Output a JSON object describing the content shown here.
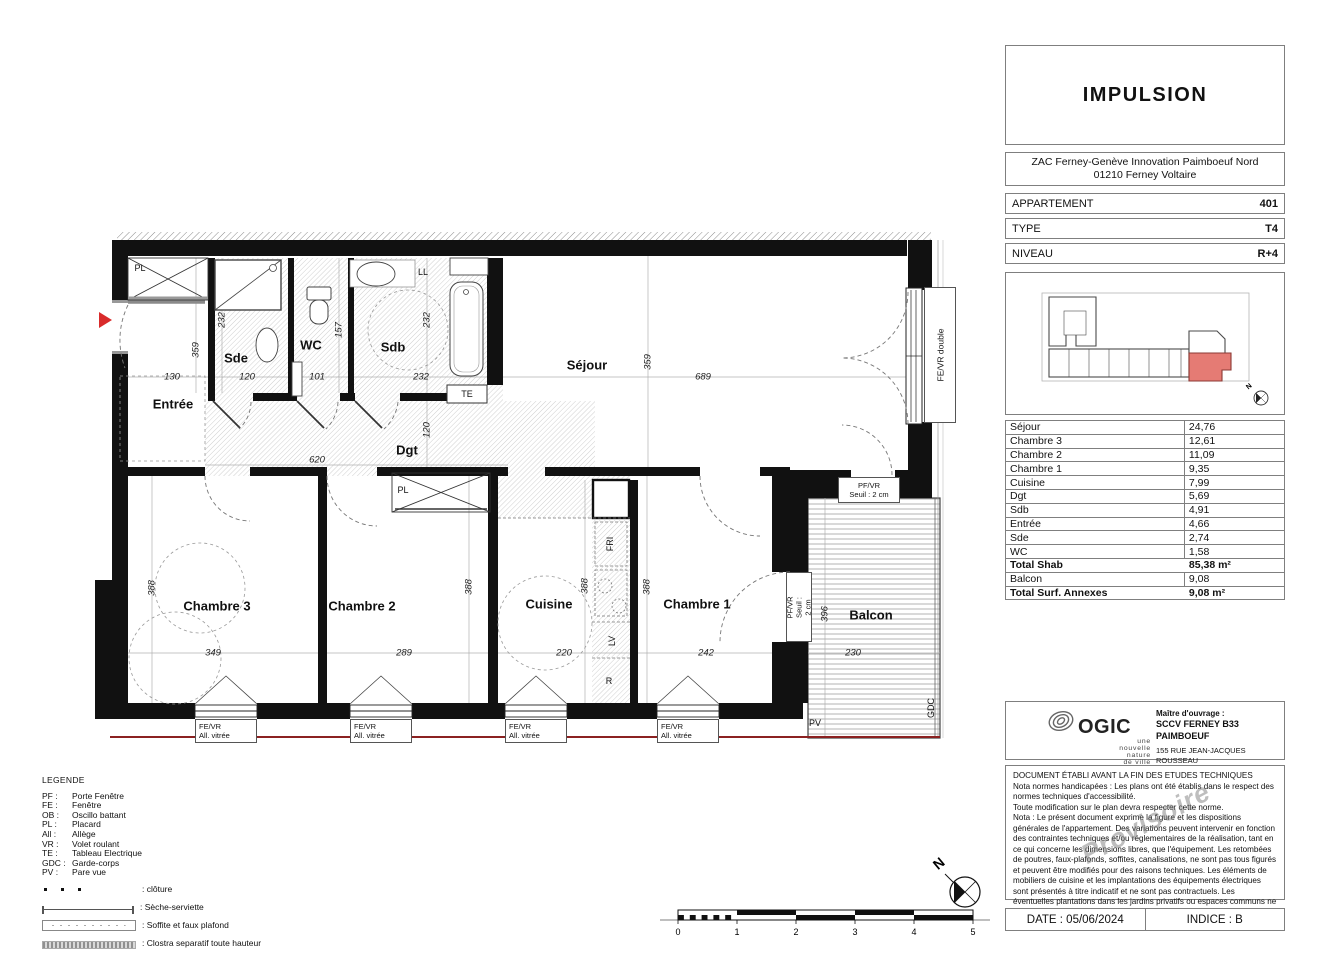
{
  "panel": {
    "project_title": "IMPULSION",
    "address_line1": "ZAC Ferney-Genève Innovation Paimboeuf Nord",
    "address_line2": "01210 Ferney Voltaire",
    "info_rows": [
      {
        "label": "APPARTEMENT",
        "value": "401"
      },
      {
        "label": "TYPE",
        "value": "T4"
      },
      {
        "label": "NIVEAU",
        "value": "R+4"
      }
    ],
    "areas": [
      {
        "label": "Séjour",
        "value": "24,76",
        "bold": false
      },
      {
        "label": "Chambre 3",
        "value": "12,61",
        "bold": false
      },
      {
        "label": "Chambre 2",
        "value": "11,09",
        "bold": false
      },
      {
        "label": "Chambre 1",
        "value": "9,35",
        "bold": false
      },
      {
        "label": "Cuisine",
        "value": "7,99",
        "bold": false
      },
      {
        "label": "Dgt",
        "value": "5,69",
        "bold": false
      },
      {
        "label": "Sdb",
        "value": "4,91",
        "bold": false
      },
      {
        "label": "Entrée",
        "value": "4,66",
        "bold": false
      },
      {
        "label": "Sde",
        "value": "2,74",
        "bold": false
      },
      {
        "label": "WC",
        "value": "1,58",
        "bold": false
      },
      {
        "label": "Total Shab",
        "value": "85,38 m²",
        "bold": true
      },
      {
        "label": "Balcon",
        "value": "9,08",
        "bold": false
      },
      {
        "label": "Total Surf. Annexes",
        "value": "9,08 m²",
        "bold": true
      }
    ],
    "developer": {
      "logo_text": "OGIC",
      "logo_tagline_lines": [
        "une",
        "nouvelle",
        "nature",
        "de ville"
      ],
      "owner_label": "Maître d'ouvrage :",
      "owner_name": "SCCV FERNEY B33 PAIMBOEUF",
      "owner_address1": "155 RUE JEAN-JACQUES ROUSSEAU",
      "owner_address2": "92 130 Issy-Les-Moulineaux"
    },
    "notes": {
      "title": "DOCUMENT ÉTABLI AVANT LA FIN DES ETUDES TECHNIQUES",
      "p1": "Nota normes handicapées : Les plans ont été établis dans le respect des normes techniques d'accessibilité.",
      "p2": "Toute modification sur le plan devra respecter cette norme.",
      "p3": "Nota : Le présent document exprime la figure et les dispositions générales de l'appartement. Des variations peuvent intervenir en fonction des contraintes techniques et/ou réglementaires de la réalisation, tant en ce qui concerne les dimensions libres, que l'équipement. Les retombées de poutres, faux-plafonds, soffites, canalisations, ne sont pas tous figurés et peuvent être modifiés pour des raisons techniques. Les éléments de mobiliers de cuisine et les implantations des équipements électriques sont présentés à titre indicatif et ne sont pas contractuels. Les éventuelles plantations dans les jardins privatifs ou espaces communs ne sont pas contractuelles. Les placards et/ou rangements intérieurs sont compris dans la surface de la pièce attenante.",
      "watermark": "Provisoire"
    },
    "footer": {
      "date": "DATE : 05/06/2024",
      "indice": "INDICE : B"
    }
  },
  "legend": {
    "title": "LEGENDE",
    "abbrev": [
      {
        "abbr": "PF :",
        "label": "Porte Fenêtre"
      },
      {
        "abbr": "FE :",
        "label": "Fenêtre"
      },
      {
        "abbr": "OB :",
        "label": "Oscillo battant"
      },
      {
        "abbr": "PL :",
        "label": "Placard"
      },
      {
        "abbr": "All :",
        "label": "Allège"
      },
      {
        "abbr": "VR :",
        "label": "Volet roulant"
      },
      {
        "abbr": "TE :",
        "label": "Tableau Electrique"
      },
      {
        "abbr": "GDC :",
        "label": "Garde-corps"
      },
      {
        "abbr": "PV :",
        "label": "Pare vue"
      }
    ],
    "symbols": [
      {
        "type": "cloture",
        "label": ": clôture"
      },
      {
        "type": "seche",
        "label": ": Sèche-serviette"
      },
      {
        "type": "soffite",
        "label": ": Soffite et faux plafond"
      },
      {
        "type": "clostra",
        "label": ": Clostra separatif toute hauteur"
      }
    ]
  },
  "plan": {
    "north": "N",
    "labels": [
      {
        "t": "Entrée",
        "x": 78,
        "y": 176,
        "k": "room"
      },
      {
        "t": "Sde",
        "x": 141,
        "y": 130,
        "k": "room"
      },
      {
        "t": "WC",
        "x": 216,
        "y": 117,
        "k": "room"
      },
      {
        "t": "Sdb",
        "x": 298,
        "y": 119,
        "k": "room"
      },
      {
        "t": "Séjour",
        "x": 492,
        "y": 137,
        "k": "room"
      },
      {
        "t": "Dgt",
        "x": 312,
        "y": 222,
        "k": "room"
      },
      {
        "t": "Chambre 3",
        "x": 122,
        "y": 378,
        "k": "room"
      },
      {
        "t": "Chambre 2",
        "x": 267,
        "y": 378,
        "k": "room"
      },
      {
        "t": "Cuisine",
        "x": 454,
        "y": 376,
        "k": "room"
      },
      {
        "t": "Chambre 1",
        "x": 602,
        "y": 376,
        "k": "room"
      },
      {
        "t": "Balcon",
        "x": 776,
        "y": 387,
        "k": "room"
      },
      {
        "t": "130",
        "x": 77,
        "y": 149,
        "k": "dim"
      },
      {
        "t": "120",
        "x": 152,
        "y": 149,
        "k": "dim"
      },
      {
        "t": "101",
        "x": 222,
        "y": 149,
        "k": "dim"
      },
      {
        "t": "232",
        "x": 326,
        "y": 149,
        "k": "dim"
      },
      {
        "t": "689",
        "x": 608,
        "y": 149,
        "k": "dim"
      },
      {
        "t": "620",
        "x": 222,
        "y": 232,
        "k": "dim"
      },
      {
        "t": "349",
        "x": 118,
        "y": 425,
        "k": "dim"
      },
      {
        "t": "289",
        "x": 309,
        "y": 425,
        "k": "dim"
      },
      {
        "t": "220",
        "x": 469,
        "y": 425,
        "k": "dim"
      },
      {
        "t": "242",
        "x": 611,
        "y": 425,
        "k": "dim"
      },
      {
        "t": "230",
        "x": 758,
        "y": 425,
        "k": "dim"
      },
      {
        "t": "359",
        "x": 101,
        "y": 122,
        "k": "dimv"
      },
      {
        "t": "232",
        "x": 127,
        "y": 92,
        "k": "dimv"
      },
      {
        "t": "157",
        "x": 244,
        "y": 102,
        "k": "dimv"
      },
      {
        "t": "232",
        "x": 332,
        "y": 92,
        "k": "dimv"
      },
      {
        "t": "359",
        "x": 553,
        "y": 134,
        "k": "dimv"
      },
      {
        "t": "120",
        "x": 332,
        "y": 202,
        "k": "dimv"
      },
      {
        "t": "388",
        "x": 57,
        "y": 360,
        "k": "dimv"
      },
      {
        "t": "388",
        "x": 374,
        "y": 359,
        "k": "dimv"
      },
      {
        "t": "388",
        "x": 490,
        "y": 358,
        "k": "dimv"
      },
      {
        "t": "388",
        "x": 552,
        "y": 359,
        "k": "dimv"
      },
      {
        "t": "396",
        "x": 730,
        "y": 386,
        "k": "dimv"
      },
      {
        "t": "PL",
        "x": 45,
        "y": 40,
        "k": "sm"
      },
      {
        "t": "LL",
        "x": 328,
        "y": 44,
        "k": "sm"
      },
      {
        "t": "TE",
        "x": 372,
        "y": 166,
        "k": "sm"
      },
      {
        "t": "PL",
        "x": 308,
        "y": 262,
        "k": "sm"
      },
      {
        "t": "FRI",
        "x": 515,
        "y": 316,
        "k": "smv"
      },
      {
        "t": "LV",
        "x": 517,
        "y": 413,
        "k": "smv"
      },
      {
        "t": "R",
        "x": 514,
        "y": 453,
        "k": "sm"
      },
      {
        "t": "PV",
        "x": 720,
        "y": 495,
        "k": "sm"
      },
      {
        "t": "GDC",
        "x": 836,
        "y": 480,
        "k": "smv"
      }
    ],
    "window_boxes": [
      {
        "x": 100,
        "y": 491,
        "l1": "FE/VR",
        "l2": "All. vitrée"
      },
      {
        "x": 255,
        "y": 491,
        "l1": "FE/VR",
        "l2": "All. vitrée"
      },
      {
        "x": 410,
        "y": 491,
        "l1": "FE/VR",
        "l2": "All. vitrée"
      },
      {
        "x": 562,
        "y": 491,
        "l1": "FE/VR",
        "l2": "All. vitrée"
      }
    ],
    "pf_boxes": [
      {
        "x": 743,
        "y": 249,
        "w": 62,
        "h": 26,
        "vert": false,
        "l1": "PF/VR",
        "l2": "Seuil : 2 cm"
      },
      {
        "x": 691,
        "y": 344,
        "w": 26,
        "h": 70,
        "vert": true,
        "l1": "PF/VR",
        "l2": "Seuil : 2 cm"
      }
    ],
    "fed_box": {
      "x": 829,
      "y": 59,
      "w": 32,
      "h": 136,
      "text": "FE/VR double"
    }
  },
  "scalebar": {
    "ticks": [
      "0",
      "1",
      "2",
      "3",
      "4",
      "5"
    ]
  },
  "colors": {
    "wall": "#111111",
    "red_line": "#8b2121",
    "entry_arrow": "#d92b2b",
    "keyplan_unit": "#e57b74"
  }
}
